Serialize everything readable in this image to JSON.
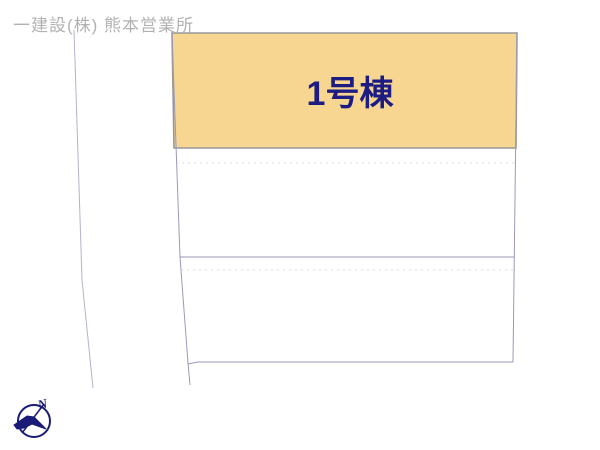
{
  "header": {
    "company": "一建設(株) 熊本営業所"
  },
  "plan": {
    "parcel_label": "1号棟",
    "compass_north_label": "N",
    "colors": {
      "parcel_fill": "#F6D690",
      "parcel_border": "#999999",
      "boundary_line": "#9A9AB8",
      "parcel_label_color": "#1C1C82",
      "header_color": "#B2B2B2",
      "compass_color": "#1A1A78"
    }
  }
}
